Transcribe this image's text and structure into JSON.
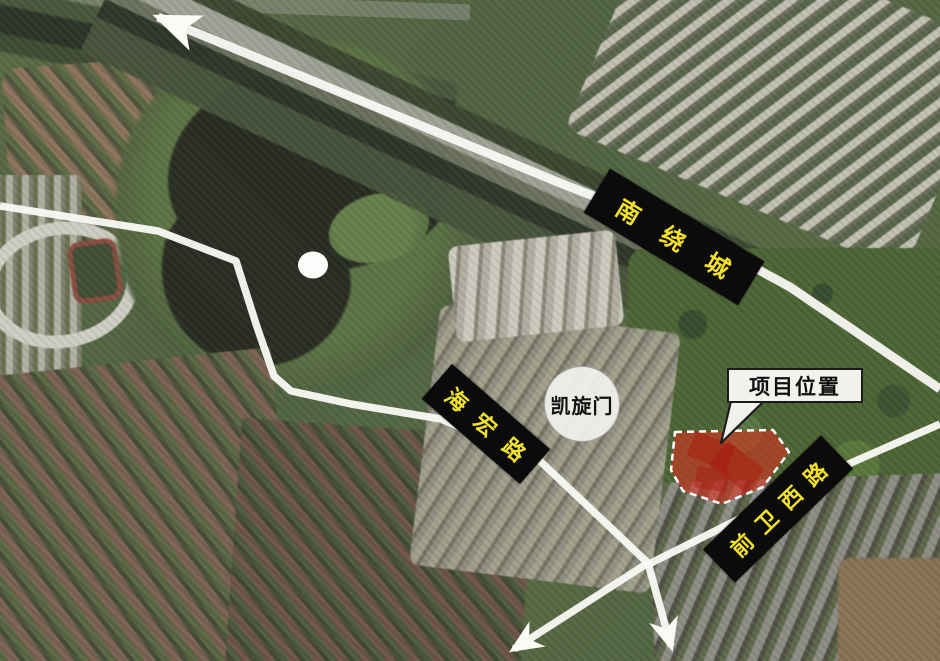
{
  "road_labels": {
    "ring_road": "南绕城",
    "haihong_road": "海宏路",
    "qianwei_west_road": "前卫西路"
  },
  "landmarks": {
    "arch_circle": "凯旋门",
    "project_callout": "项目位置"
  },
  "icons": {
    "arrow_up_left": "road-direction-arrow-up-left",
    "arrow_down": "road-direction-arrow-down",
    "arrow_down_left": "road-direction-arrow-down-left",
    "white_dot": "lake-white-dot-marker"
  },
  "colors": {
    "road_label_bg": "#0b0b0b",
    "road_label_text": "#f2e12c",
    "road_overlay_white": "#fafaf6",
    "project_area_red": "#dd2f1e",
    "project_dash_white": "#ffffff",
    "callout_bg": "#f2f1ec",
    "callout_border": "#1b1b1b",
    "landmark_circle_bg": "#f3f2ee",
    "white_dot": "#fcfcfa"
  }
}
